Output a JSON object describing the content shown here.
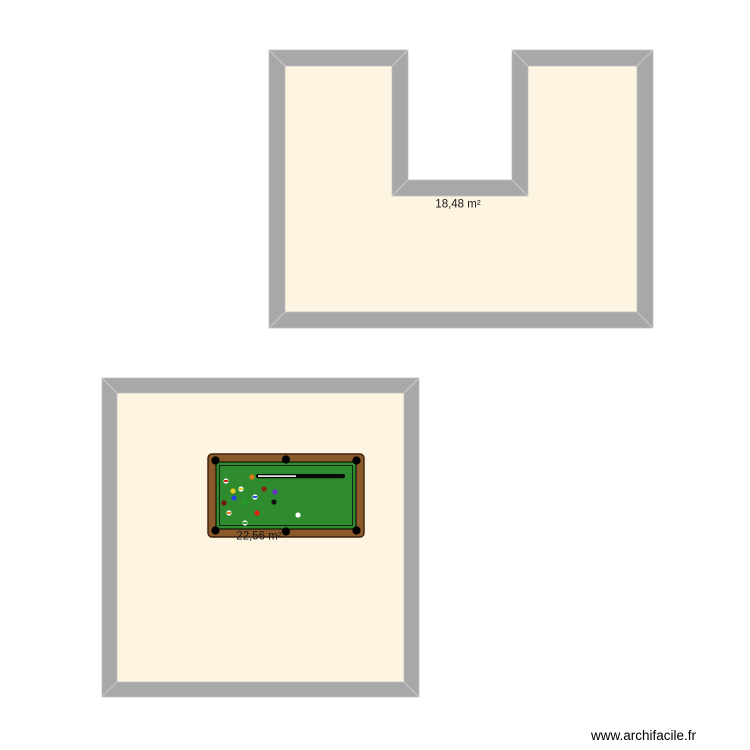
{
  "app": {
    "watermark": "www.archifacile.fr"
  },
  "canvas": {
    "background_color": "#ffffff",
    "wall_color": "#a8a8a8",
    "wall_bevel_color": "#c9c9c9",
    "floor_color": "#fdf5e2"
  },
  "rooms": [
    {
      "id": "u-shaped-room",
      "shape": "u-shape",
      "area_label": "18,48 m²"
    },
    {
      "id": "square-room",
      "shape": "rectangle",
      "area_label": "22,56 m²"
    }
  ],
  "furniture": {
    "billiard_table": {
      "name": "billiard-table",
      "frame_color": "#8b5a2b",
      "frame_outline_color": "#3d1e0a",
      "felt_color": "#2e8b2e",
      "pocket_color": "#000000",
      "cue": {
        "shaft_color": "#f8f8f0",
        "butt_color": "#0a0a0a"
      },
      "balls": [
        {
          "x": 226,
          "y": 481,
          "color": "#cc2211",
          "stripe": true
        },
        {
          "x": 252,
          "y": 477,
          "color": "#e07818",
          "stripe": false
        },
        {
          "x": 241,
          "y": 489,
          "color": "#e0cc22",
          "stripe": true
        },
        {
          "x": 233,
          "y": 491,
          "color": "#e0cc22",
          "stripe": false
        },
        {
          "x": 264,
          "y": 489,
          "color": "#8b2015",
          "stripe": false
        },
        {
          "x": 275,
          "y": 492,
          "color": "#6633cc",
          "stripe": false
        },
        {
          "x": 234,
          "y": 498,
          "color": "#2244dd",
          "stripe": false
        },
        {
          "x": 255,
          "y": 497,
          "color": "#2244dd",
          "stripe": true
        },
        {
          "x": 224,
          "y": 503,
          "color": "#77150c",
          "stripe": false
        },
        {
          "x": 274,
          "y": 502,
          "color": "#111111",
          "stripe": false
        },
        {
          "x": 245,
          "y": 503,
          "color": "#22a022",
          "stripe": false
        },
        {
          "x": 229,
          "y": 513,
          "color": "#e07818",
          "stripe": true
        },
        {
          "x": 257,
          "y": 513,
          "color": "#dd2211",
          "stripe": false
        },
        {
          "x": 245,
          "y": 523,
          "color": "#22a022",
          "stripe": true
        },
        {
          "x": 298,
          "y": 515,
          "color": "#ffffff",
          "stripe": false
        }
      ]
    }
  }
}
